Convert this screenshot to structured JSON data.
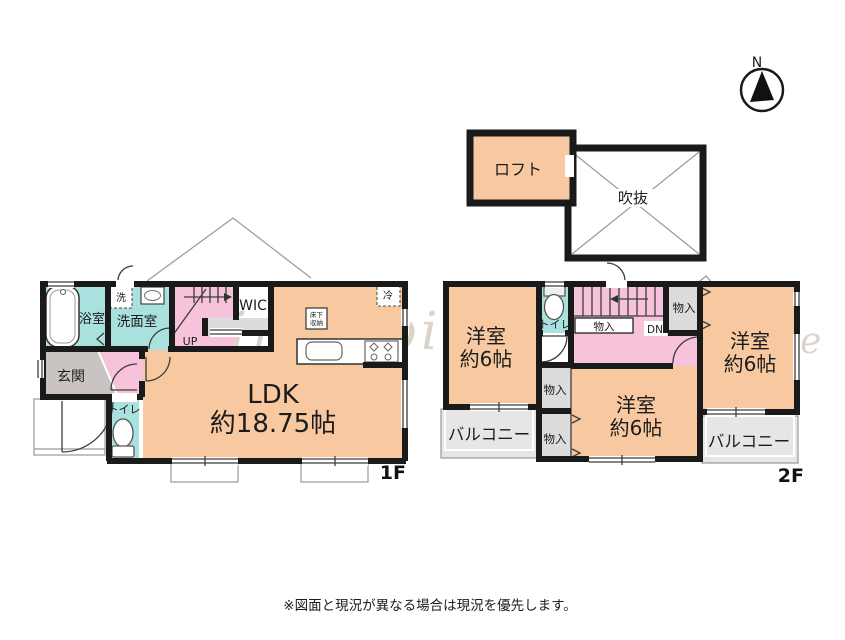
{
  "plan": {
    "compass_n": "N",
    "watermark_primary": "Clair Supithy",
    "watermark_secondary": "Real estate",
    "disclaimer": "※図面と現況が異なる場合は現況を優先します。"
  },
  "loft": {
    "loft_label": "ロフト",
    "void_label": "吹抜"
  },
  "floor1": {
    "floor_tag": "1F",
    "bath": "浴室",
    "washroom": "洗面室",
    "washer": "洗",
    "wic": "WIC",
    "stairs": "UP",
    "entrance": "玄関",
    "toilet": "トイレ",
    "ldk_line1": "LDK",
    "ldk_line2": "約18.75帖",
    "underfloor_line1": "床下",
    "underfloor_line2": "収納",
    "fridge": "冷"
  },
  "floor2": {
    "floor_tag": "2F",
    "room": "洋室",
    "room_size": "約6帖",
    "toilet": "トイレ",
    "closet": "物入",
    "stairs": "DN",
    "balcony": "バルコニー"
  },
  "colors": {
    "room_orange": "#F8C9A0",
    "room_teal": "#A9E1DE",
    "room_pink": "#F6C3DA",
    "entrance_gray": "#C9C4C1",
    "closet_gray": "#DCDCDC",
    "balcony_gray": "#E6E6E6",
    "wall_black": "#1A1A1A"
  }
}
